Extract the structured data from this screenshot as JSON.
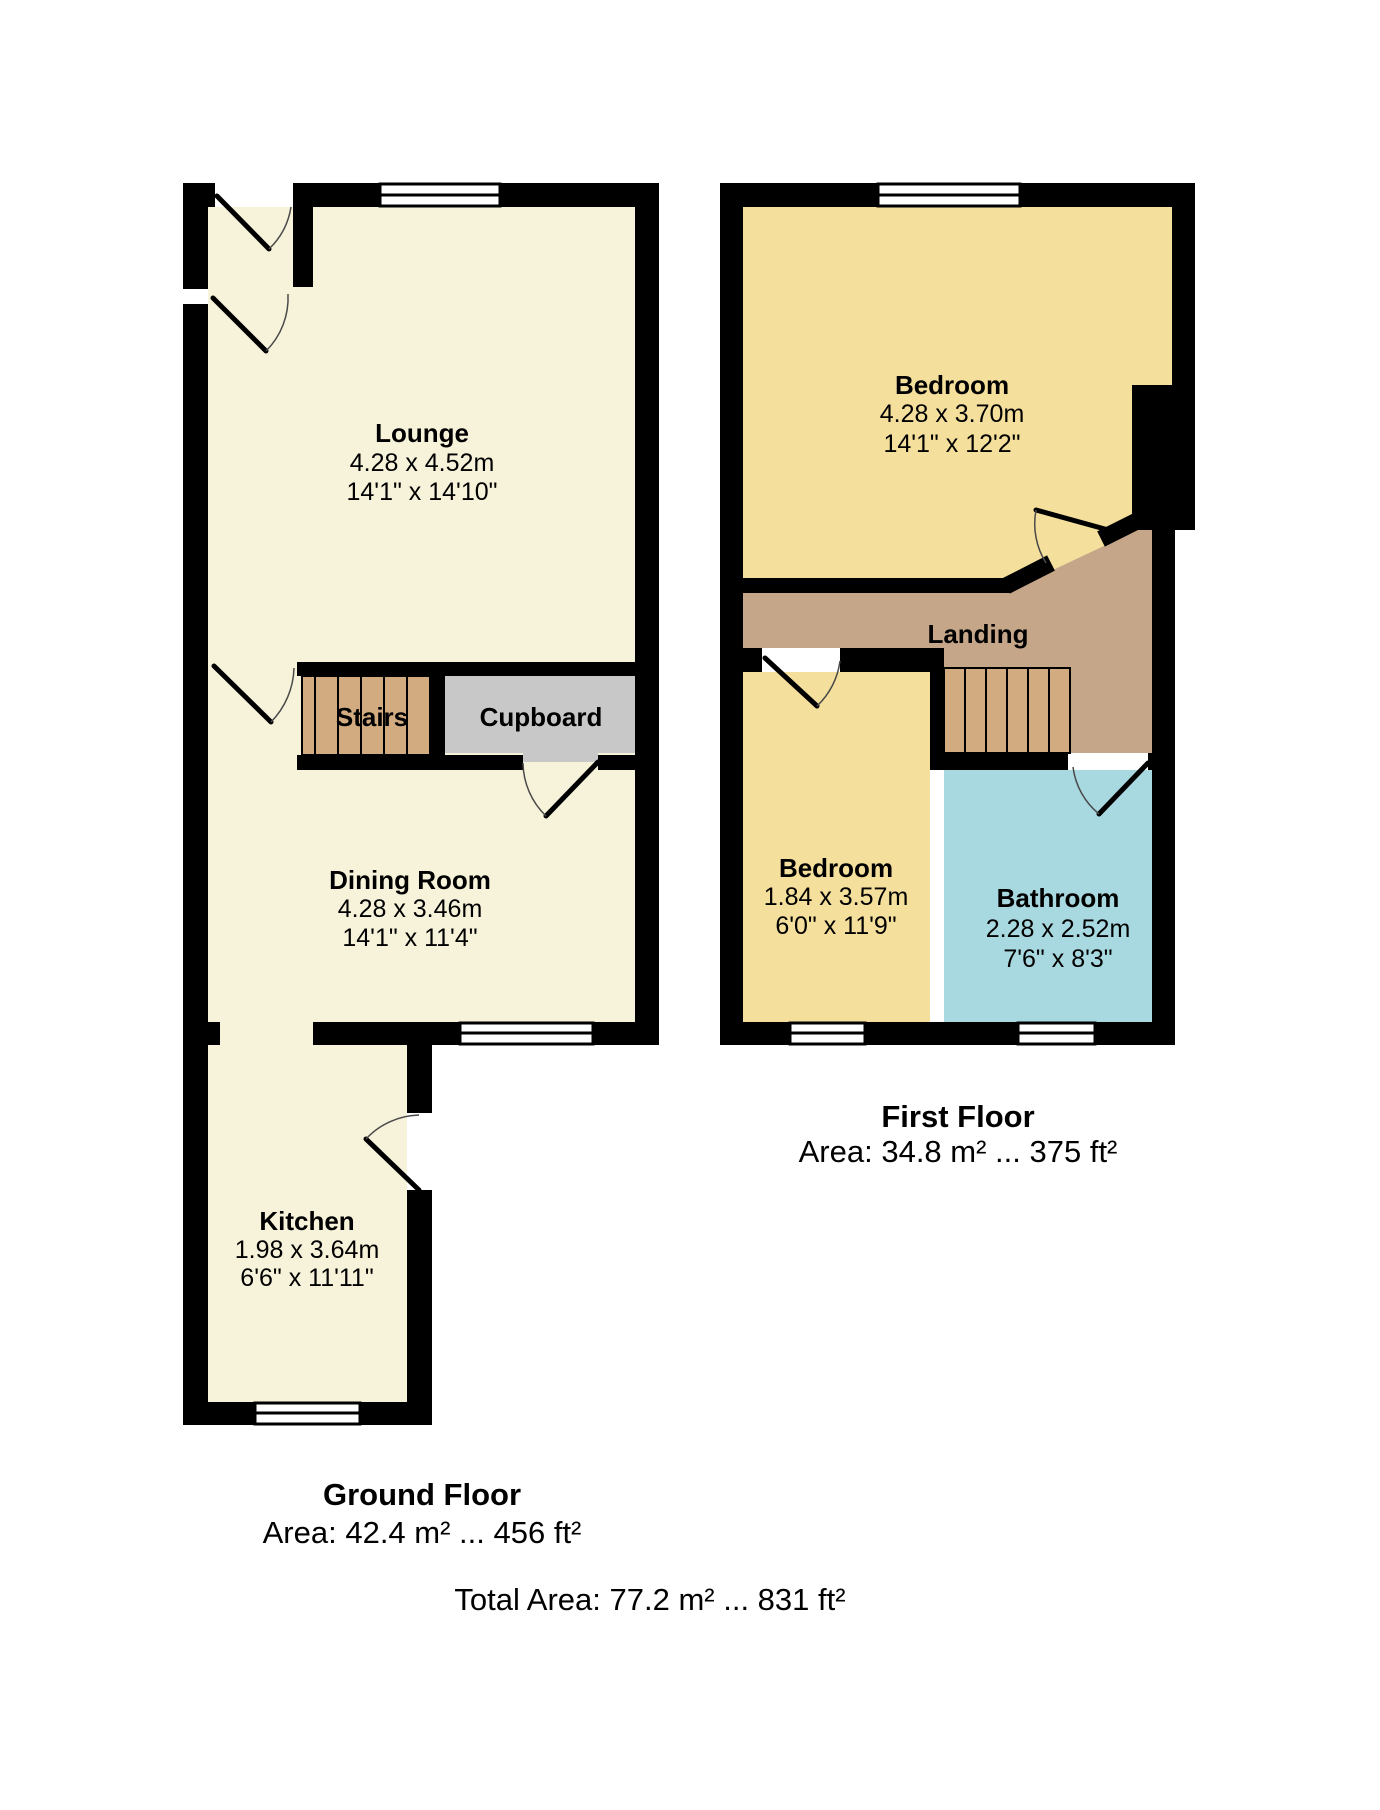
{
  "colors": {
    "wall": "#000000",
    "ground_room_fill": "#f7f3da",
    "bedroom_fill": "#f5df9c",
    "landing_fill": "#c6a689",
    "stairs_fill": "#d2ab80",
    "cupboard_fill": "#c8c8c8",
    "bathroom_fill": "#a8d8e0",
    "background": "#ffffff"
  },
  "ground_floor": {
    "caption": "Ground Floor",
    "area": "Area: 42.4 m² ... 456 ft²",
    "rooms": {
      "lounge": {
        "name": "Lounge",
        "metric": "4.28 x 4.52m",
        "imperial": "14'1\" x 14'10\""
      },
      "dining_room": {
        "name": "Dining Room",
        "metric": "4.28 x 3.46m",
        "imperial": "14'1\" x 11'4\""
      },
      "kitchen": {
        "name": "Kitchen",
        "metric": "1.98 x 3.64m",
        "imperial": "6'6\" x 11'11\""
      },
      "stairs": {
        "name": "Stairs"
      },
      "cupboard": {
        "name": "Cupboard"
      }
    }
  },
  "first_floor": {
    "caption": "First Floor",
    "area": "Area: 34.8 m² ... 375 ft²",
    "rooms": {
      "bedroom_1": {
        "name": "Bedroom",
        "metric": "4.28 x 3.70m",
        "imperial": "14'1\" x 12'2\""
      },
      "bedroom_2": {
        "name": "Bedroom",
        "metric": "1.84 x 3.57m",
        "imperial": "6'0\" x 11'9\""
      },
      "bathroom": {
        "name": "Bathroom",
        "metric": "2.28 x 2.52m",
        "imperial": "7'6\" x 8'3\""
      },
      "landing": {
        "name": "Landing"
      }
    }
  },
  "total_area": "Total Area: 77.2 m² ... 831 ft²"
}
